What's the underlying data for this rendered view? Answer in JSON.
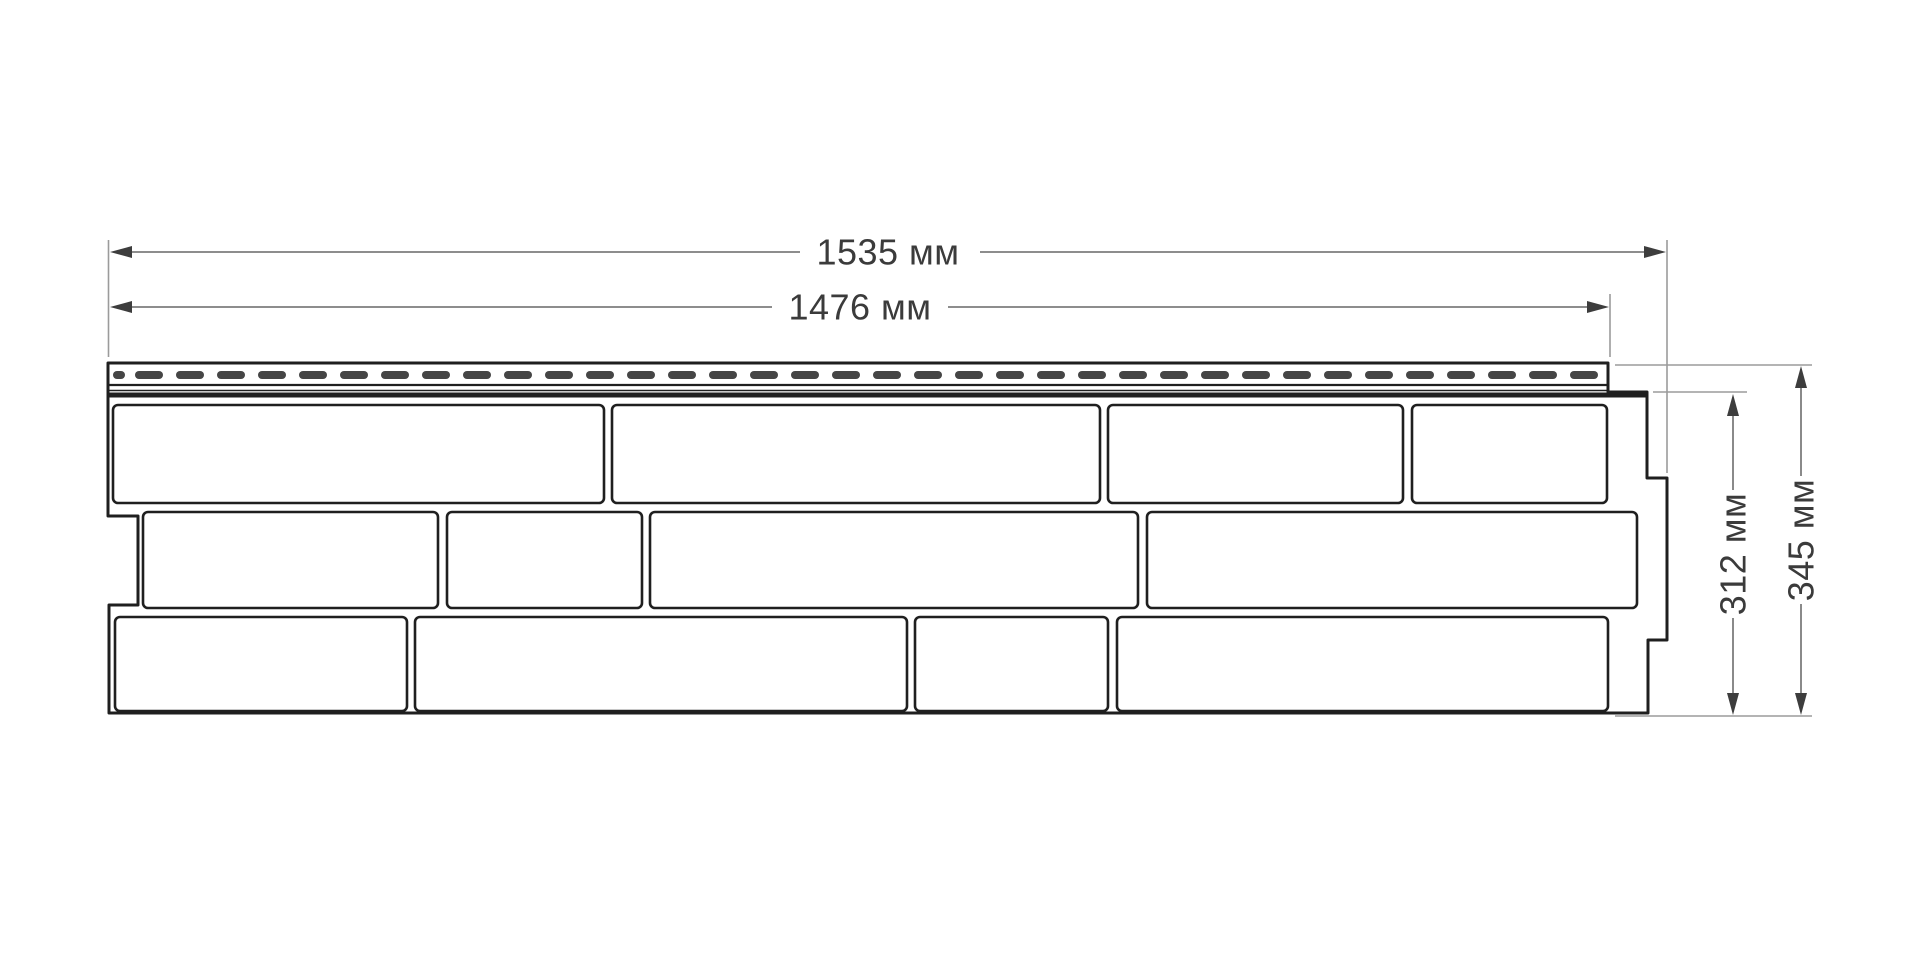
{
  "drawing": {
    "kind": "facade-panel-dimension-drawing",
    "dimensions": {
      "total_width": "1535 мм",
      "useful_width": "1476 мм",
      "useful_height": "312 мм",
      "total_height": "345 мм"
    },
    "values_mm": {
      "total_width": 1535,
      "useful_width": 1476,
      "useful_height": 312,
      "total_height": 345
    },
    "unit": "мм"
  },
  "colors": {
    "line": "#1f1f1f",
    "dim": "#7d7d7d",
    "ext": "#9b9b9b",
    "arrow": "#3d3d3d",
    "text": "#3b3b3b",
    "slot": "#454545",
    "bg": "#ffffff"
  }
}
